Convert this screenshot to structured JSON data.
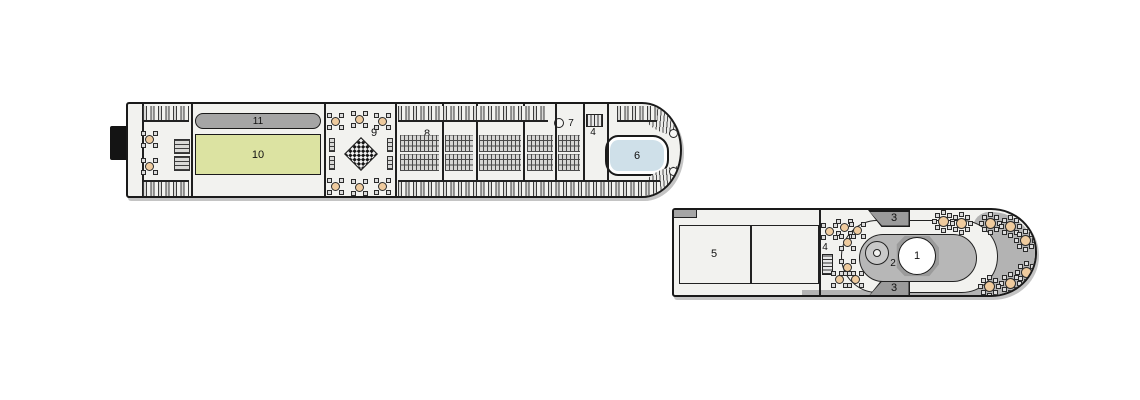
{
  "document": {
    "type": "ship-deck-plan"
  },
  "colors": {
    "deck": "#f2f2ef",
    "pill-gray": "#a5a5a5",
    "putting-green": "#dce3a2",
    "pool-blue": "#cfe0e9",
    "structure": "#b7b7b7",
    "mid-gray": "#b3b3b3",
    "dark-gray": "#9b9b9b",
    "table-tan": "#efcb9e"
  },
  "sun_deck": {
    "area_labels": {
      "walking_track": "11",
      "putting_green": "10",
      "giant_chess": "9",
      "sun_loungers": "8",
      "game_circle": "7",
      "bar": "4",
      "pool": "6"
    }
  },
  "aft_deck": {
    "area_labels": {
      "lounge_rooms": "5",
      "bar": "4",
      "whirlpool": "2",
      "pool": "1",
      "stairs_top": "3",
      "stairs_bottom": "3"
    }
  },
  "furniture": {
    "sun_deck": {
      "tables4": [
        [
          21,
          35
        ],
        [
          21,
          62
        ],
        [
          207,
          17
        ],
        [
          231,
          15
        ],
        [
          254,
          17
        ],
        [
          207,
          82
        ],
        [
          231,
          83
        ],
        [
          254,
          82
        ]
      ],
      "strips_top": [
        [
          15,
          2,
          46
        ],
        [
          270,
          2,
          150
        ],
        [
          489,
          2,
          40
        ]
      ],
      "strips_bottom": [
        [
          15,
          76,
          46
        ],
        [
          270,
          76,
          262
        ]
      ],
      "racks": [
        [
          46,
          35,
          16,
          15
        ],
        [
          46,
          52,
          16,
          15
        ]
      ],
      "benches": [
        [
          201,
          34,
          6,
          14
        ],
        [
          201,
          52,
          6,
          14
        ],
        [
          259,
          34,
          6,
          14
        ],
        [
          259,
          52,
          6,
          14
        ]
      ],
      "lounger_blocks": [
        [
          272,
          31,
          39,
          17
        ],
        [
          317,
          31,
          28,
          17
        ],
        [
          351,
          31,
          42,
          17
        ],
        [
          399,
          31,
          26,
          17
        ],
        [
          430,
          31,
          22,
          17
        ],
        [
          272,
          50,
          39,
          17
        ],
        [
          317,
          50,
          28,
          17
        ],
        [
          351,
          50,
          42,
          17
        ],
        [
          399,
          50,
          26,
          17
        ],
        [
          430,
          50,
          22,
          17
        ]
      ],
      "walls": [
        14,
        63,
        196,
        267,
        314,
        348,
        395,
        427,
        455,
        479
      ],
      "dots": [
        [
          541,
          25
        ],
        [
          541,
          63
        ]
      ]
    },
    "aft_deck": {
      "tables4": [
        [
          155,
          21
        ],
        [
          170,
          17
        ],
        [
          183,
          20
        ],
        [
          173,
          32
        ],
        [
          173,
          57
        ],
        [
          165,
          69
        ],
        [
          181,
          69
        ]
      ],
      "tables8": [
        [
          269,
          11
        ],
        [
          287,
          13
        ],
        [
          316,
          13
        ],
        [
          336,
          16
        ],
        [
          351,
          30
        ],
        [
          352,
          62
        ],
        [
          336,
          73
        ],
        [
          315,
          76
        ]
      ]
    }
  }
}
